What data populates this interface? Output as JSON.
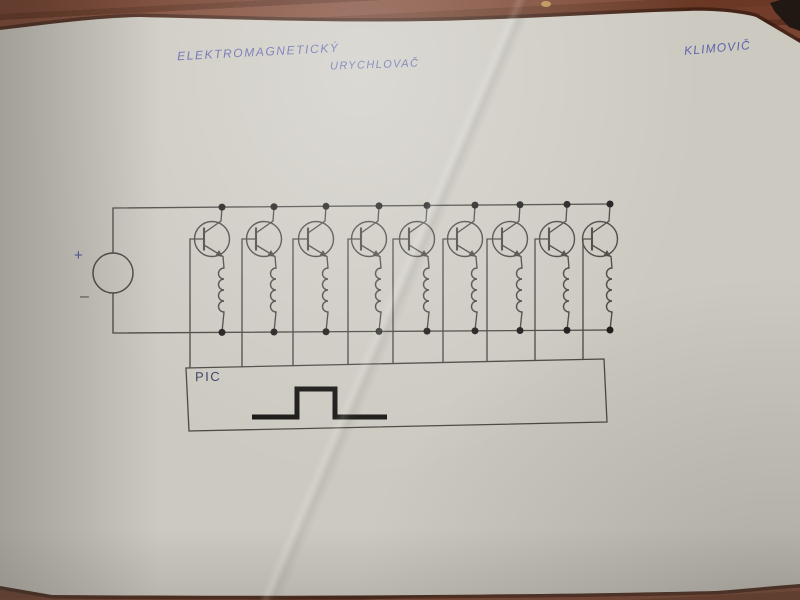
{
  "scene": {
    "description": "Hand-drawn electronic schematic on a white paper sheet photographed on a dark red-brown wooden table",
    "colors": {
      "wood": "#6e3a27",
      "wood_shadow": "#3c1d12",
      "paper": "#ccc9c1",
      "wire_ink": "#4a4642",
      "dot_ink": "#1d1b19",
      "waveform_ink": "#181614",
      "pen_ink": "#5d63ab"
    }
  },
  "annotations": {
    "title_line1": "ELEKTROMAGNETICKÝ",
    "title_line2": "URYCHLOVAČ",
    "author": "KLIMOVIČ"
  },
  "schematic": {
    "type": "circuit",
    "description": "Electromagnetic accelerator driver: nine identical stages, each an NPN transistor switching a coil (electromagnet) between the supply rails; all transistor bases are driven from a PIC microcontroller box that outputs a single rectangular pulse.",
    "power_source": {
      "plus": "+",
      "minus": "–"
    },
    "controller": {
      "label": "PIC",
      "waveform": "single positive rectangular pulse"
    },
    "stage_count": 9,
    "layout": {
      "column_x": [
        222,
        274,
        326,
        379,
        427,
        475,
        520,
        567,
        610
      ],
      "base_x": [
        190,
        242,
        293,
        348,
        393,
        443,
        487,
        535,
        583
      ],
      "top_rail": [
        [
          113,
          208
        ],
        [
          611,
          204
        ]
      ],
      "bottom_rail": [
        [
          113,
          333
        ],
        [
          612,
          330
        ]
      ],
      "source_center": [
        113,
        273
      ],
      "source_radius": 20,
      "transistor_cy": 239,
      "transistor_r": 17.5,
      "coil_top": 268,
      "coil_bumps": 4,
      "coil_bump_h": 11,
      "pic_box": [
        [
          186,
          368
        ],
        [
          604,
          359
        ],
        [
          607,
          422
        ],
        [
          189,
          431
        ]
      ],
      "pulse": [
        [
          252,
          417
        ],
        [
          297,
          417
        ],
        [
          297,
          389
        ],
        [
          335,
          389
        ],
        [
          335,
          417
        ],
        [
          387,
          417
        ]
      ]
    }
  }
}
